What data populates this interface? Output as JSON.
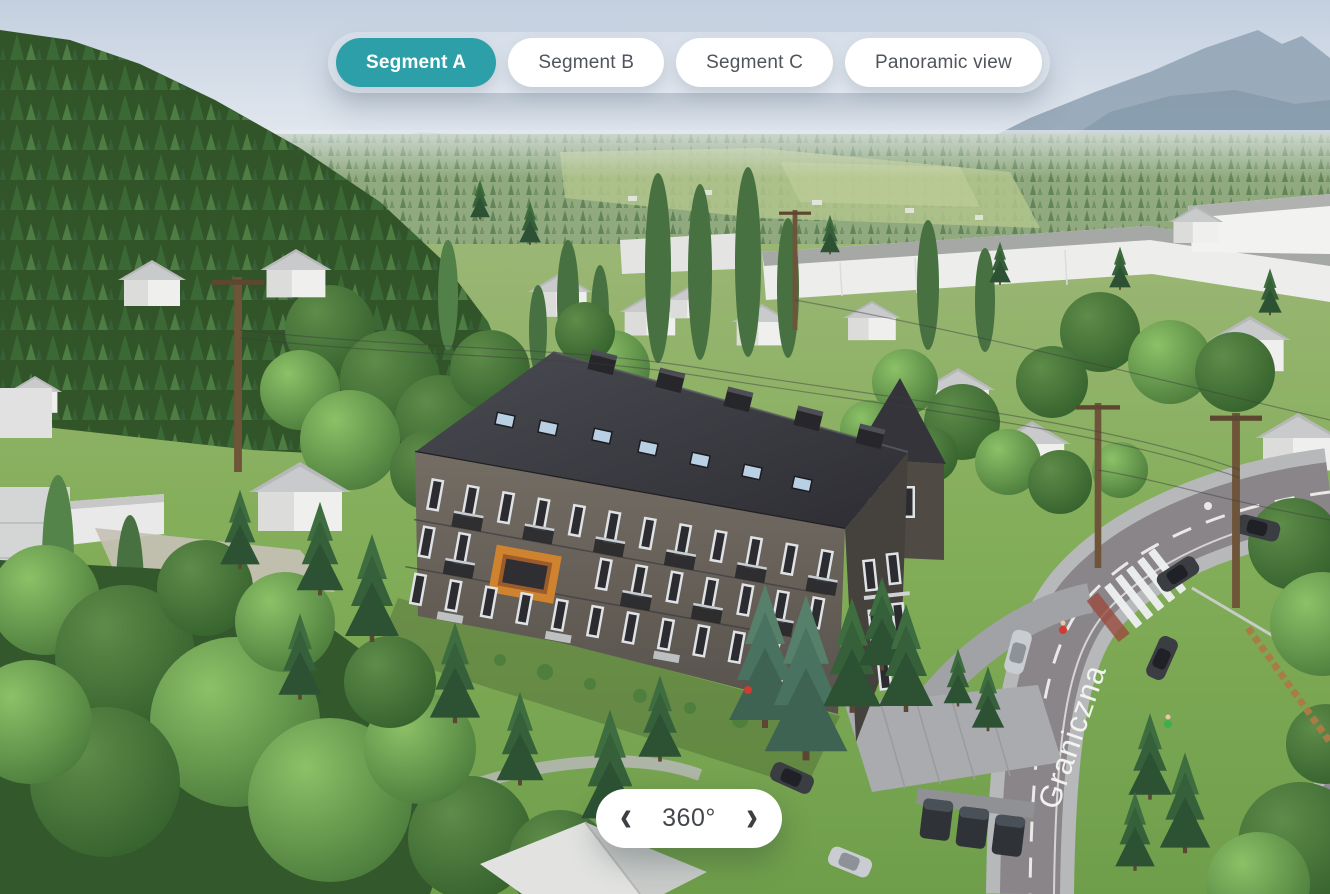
{
  "tabs": {
    "items": [
      {
        "label": "Segment A",
        "active": true
      },
      {
        "label": "Segment B",
        "active": false
      },
      {
        "label": "Segment C",
        "active": false
      },
      {
        "label": "Panoramic view",
        "active": false
      }
    ]
  },
  "rotation": {
    "label": "360°",
    "chevron_left_icon": "‹",
    "chevron_right_icon": "›"
  },
  "scene": {
    "street_label": "Graniczna"
  },
  "colors": {
    "accent_teal": "#2D9FA8",
    "pill_background": "#FFFFFF",
    "pill_text": "#50555B",
    "building_roof": "#3A3A40",
    "building_wall": "#6B655D",
    "balcony_accent_orange": "#D0832F",
    "road_asphalt": "#8A8589",
    "grass": "#7FAD58",
    "sky": "#CBD6E2"
  }
}
